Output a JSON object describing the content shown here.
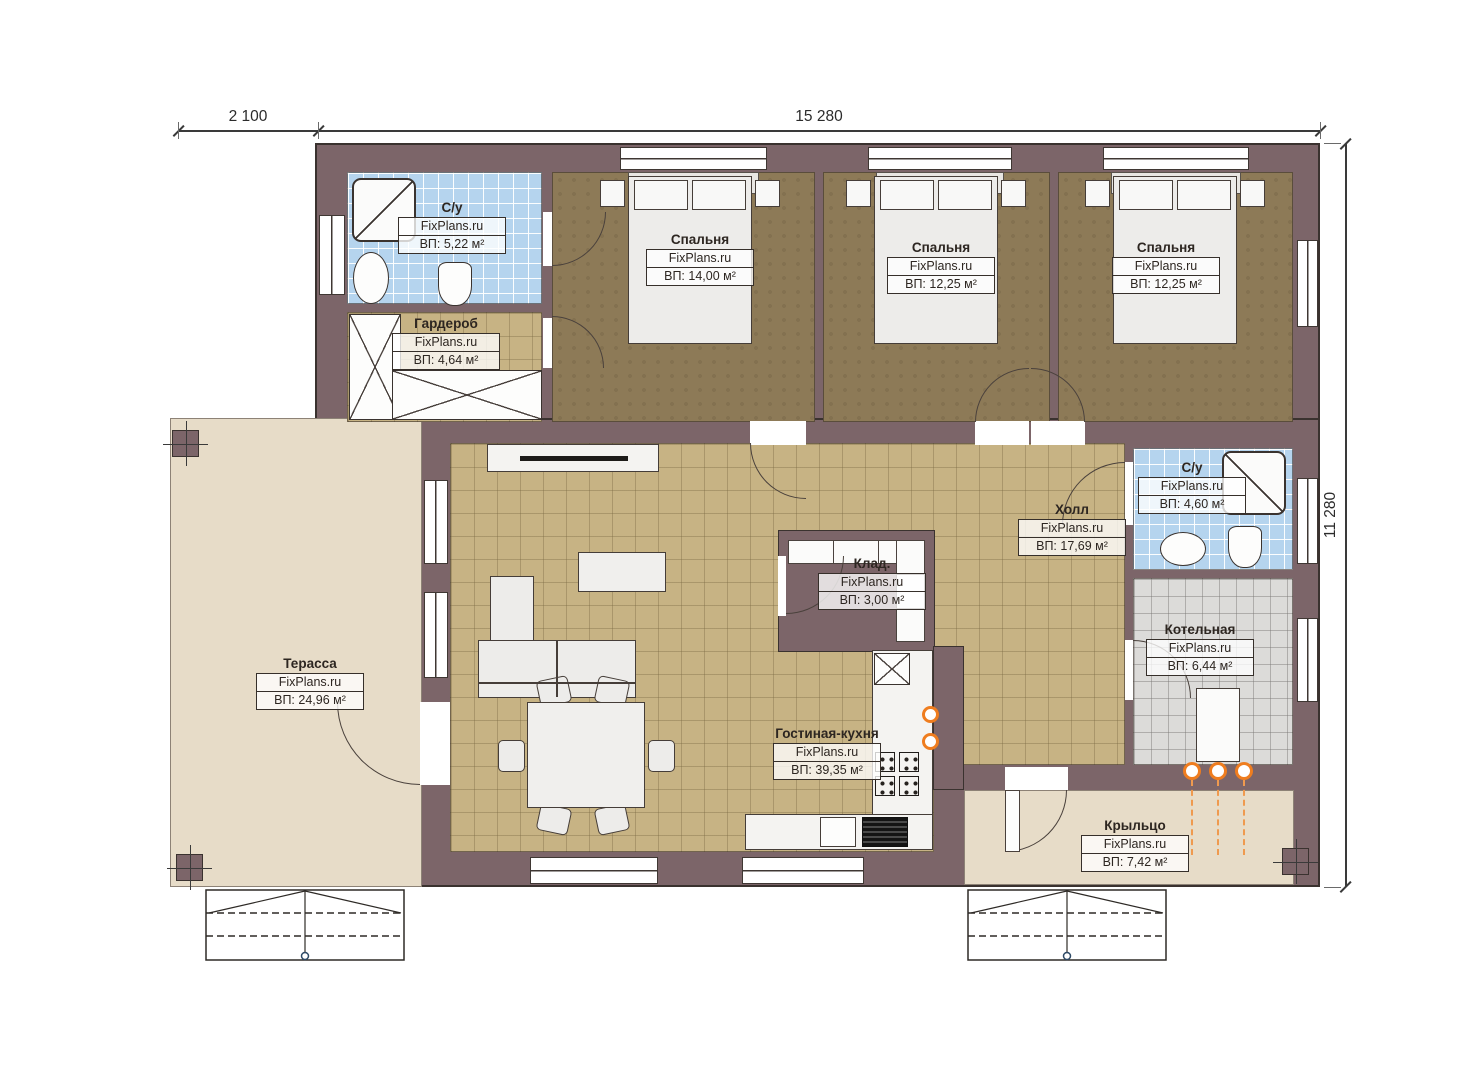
{
  "brand": "FixPlans.ru",
  "dimensions": {
    "terrace_width": "2 100",
    "building_width": "15 280",
    "building_depth": "11 280"
  },
  "rooms": [
    {
      "id": "bath1",
      "name": "С/у",
      "area": "ВП: 5,22 м²"
    },
    {
      "id": "wardrobe",
      "name": "Гардероб",
      "area": "ВП: 4,64 м²"
    },
    {
      "id": "bedroom1",
      "name": "Спальня",
      "area": "ВП: 14,00 м²"
    },
    {
      "id": "bedroom2",
      "name": "Спальня",
      "area": "ВП: 12,25 м²"
    },
    {
      "id": "bedroom3",
      "name": "Спальня",
      "area": "ВП: 12,25 м²"
    },
    {
      "id": "hall",
      "name": "Холл",
      "area": "ВП: 17,69 м²"
    },
    {
      "id": "bath2",
      "name": "С/у",
      "area": "ВП: 4,60 м²"
    },
    {
      "id": "boiler",
      "name": "Котельная",
      "area": "ВП: 6,44 м²"
    },
    {
      "id": "storage",
      "name": "Клад.",
      "area": "ВП: 3,00 м²"
    },
    {
      "id": "living",
      "name": "Гостиная-кухня",
      "area": "ВП: 39,35 м²"
    },
    {
      "id": "terrace",
      "name": "Терасса",
      "area": "ВП: 24,96 м²"
    },
    {
      "id": "porch",
      "name": "Крыльцо",
      "area": "ВП: 7,42 м²"
    }
  ],
  "colors": {
    "wall": "#7c6569",
    "bedroom_floor": "#8d7a57",
    "living_floor": "#c7b384",
    "bathroom_floor": "#b5d4ee",
    "boiler_floor": "#dcdbd9",
    "outside_floor": "#e7dcc8",
    "pipe_accent": "#ef7d1f"
  }
}
